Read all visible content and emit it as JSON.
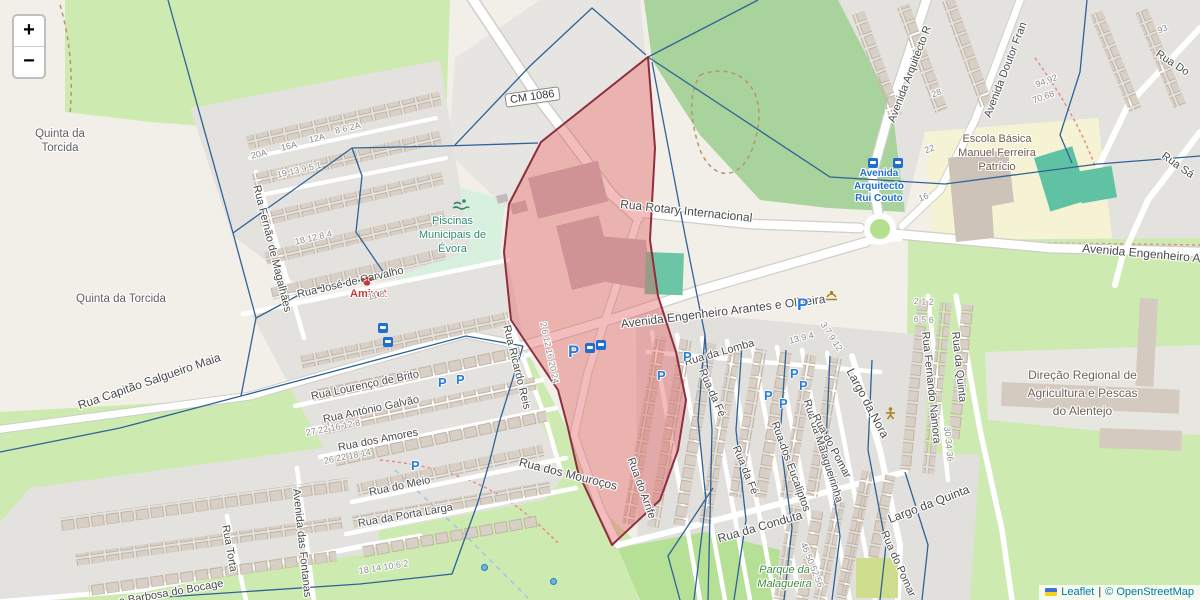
{
  "map": {
    "controls": {
      "zoom_in": "+",
      "zoom_out": "−"
    },
    "attribution": {
      "leaflet": "Leaflet",
      "separator": "|",
      "copyright": "© OpenStreetMap"
    },
    "shield": "CM 1086",
    "icon_labels": {
      "parking": "P"
    },
    "streets": {
      "fernao_magalhaes": "Rua Fernão de Magalhães",
      "jose_carvalho": "Rua José de Carvalho",
      "capitao_salgueiro": "Rua Capitão Salgueiro Maia",
      "lourenco_brito": "Rua Lourenço de Brito",
      "antonio_galvao": "Rua António Galvão",
      "amores": "Rua dos Amores",
      "meio": "Rua do Meio",
      "porta_larga": "Rua da Porta Larga",
      "torta": "Rua Torta",
      "bocage": "a Barbosa do Bocage",
      "fontanas": "Avenida das Fontanas",
      "ricardo_reis": "Rua Ricardo Reis",
      "mourocos": "Rua dos Mouroços",
      "arrife": "Rua do Arrife",
      "rotary": "Rua Rotary Internacional",
      "arantes": "Avenida Engenheiro Arantes e Oliveira",
      "engenheiro_right": "Avenida Engenheiro Ar",
      "lomba": "Rua da Lomba",
      "fe": "Rua da Fé",
      "eucaliptos": "Rua dos Eucaliptos",
      "malagueirinha": "Rua da Malagueirinha",
      "pomar": "Rua do Pomar",
      "largo_nora": "Largo da Nora",
      "largo_quinta": "Largo da Quinta",
      "conduta": "Rua da Conduta",
      "fernando_namora": "Rua Fernando Namora",
      "rua_quinta": "Rua da Quinta",
      "arquitecto": "Avenida Arquitecto R",
      "doutor": "Avenida Doutor Fran",
      "rua_do": "Rua Do",
      "rua_sa": "Rua Sá"
    },
    "places": {
      "quinta_torcida": "Quinta da Torcida",
      "piscinas": "Piscinas Municipais de Évora",
      "amivet": "Amivet",
      "escola": "Escola Básica Manuel Ferreira Patrício",
      "paragem": "Avenida Arquitecto Rui Couto",
      "direcao": "Direção Regional de Agricultura e Pescas do Alentejo",
      "parque": "Parque da Malagueira"
    },
    "numbers": [
      "20A",
      "16A",
      "12A",
      "8 6 2A",
      "19 13 9 5 1",
      "18 12 8 4",
      "27 22 16 12 8",
      "26 22 18 14",
      "18 14 10 6 2",
      "2 6 12 16 20 24",
      "46 50 52 56",
      "30 34 36",
      "94,92",
      "70,68",
      "28",
      "22",
      "16",
      "93",
      "13 9 4",
      "3 7 9 12",
      "2 1 2",
      "6 5 6",
      "11 8"
    ],
    "colors": {
      "selection_fill": "#E25B5B",
      "selection_stroke": "#8E2F40",
      "boundary": "#2F6396",
      "parking": "#2B7CD8",
      "transit": "#1F6FD1",
      "poi_green": "#2E8B6E",
      "park_green": "#3E8E3E",
      "poi_red": "#C23B3B",
      "label": "#4A4A4A",
      "link": "#0078A8"
    }
  }
}
